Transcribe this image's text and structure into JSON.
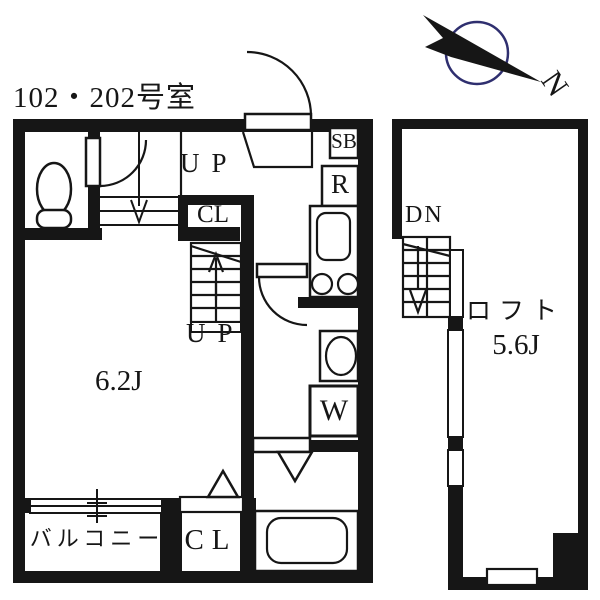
{
  "unit_label": "102・202号室",
  "compass": {
    "north_label": "N",
    "ring_color": "#2f2f6f"
  },
  "colors": {
    "wall": "#161616",
    "background": "#ffffff"
  },
  "floor1": {
    "stairs_up_entrance_label": "UP",
    "closet_upper_label": "CL",
    "stairs_to_loft_label": "UP",
    "entrance_shoe_box_label": "SB",
    "refrigerator_label": "R",
    "washing_machine_label": "W",
    "main_room_size": "6.2J",
    "balcony_label": "バルコニー",
    "closet_lower_label": "CL"
  },
  "loft": {
    "stairs_down_label": "DN",
    "name": "ロフト",
    "size": "5.6J"
  }
}
